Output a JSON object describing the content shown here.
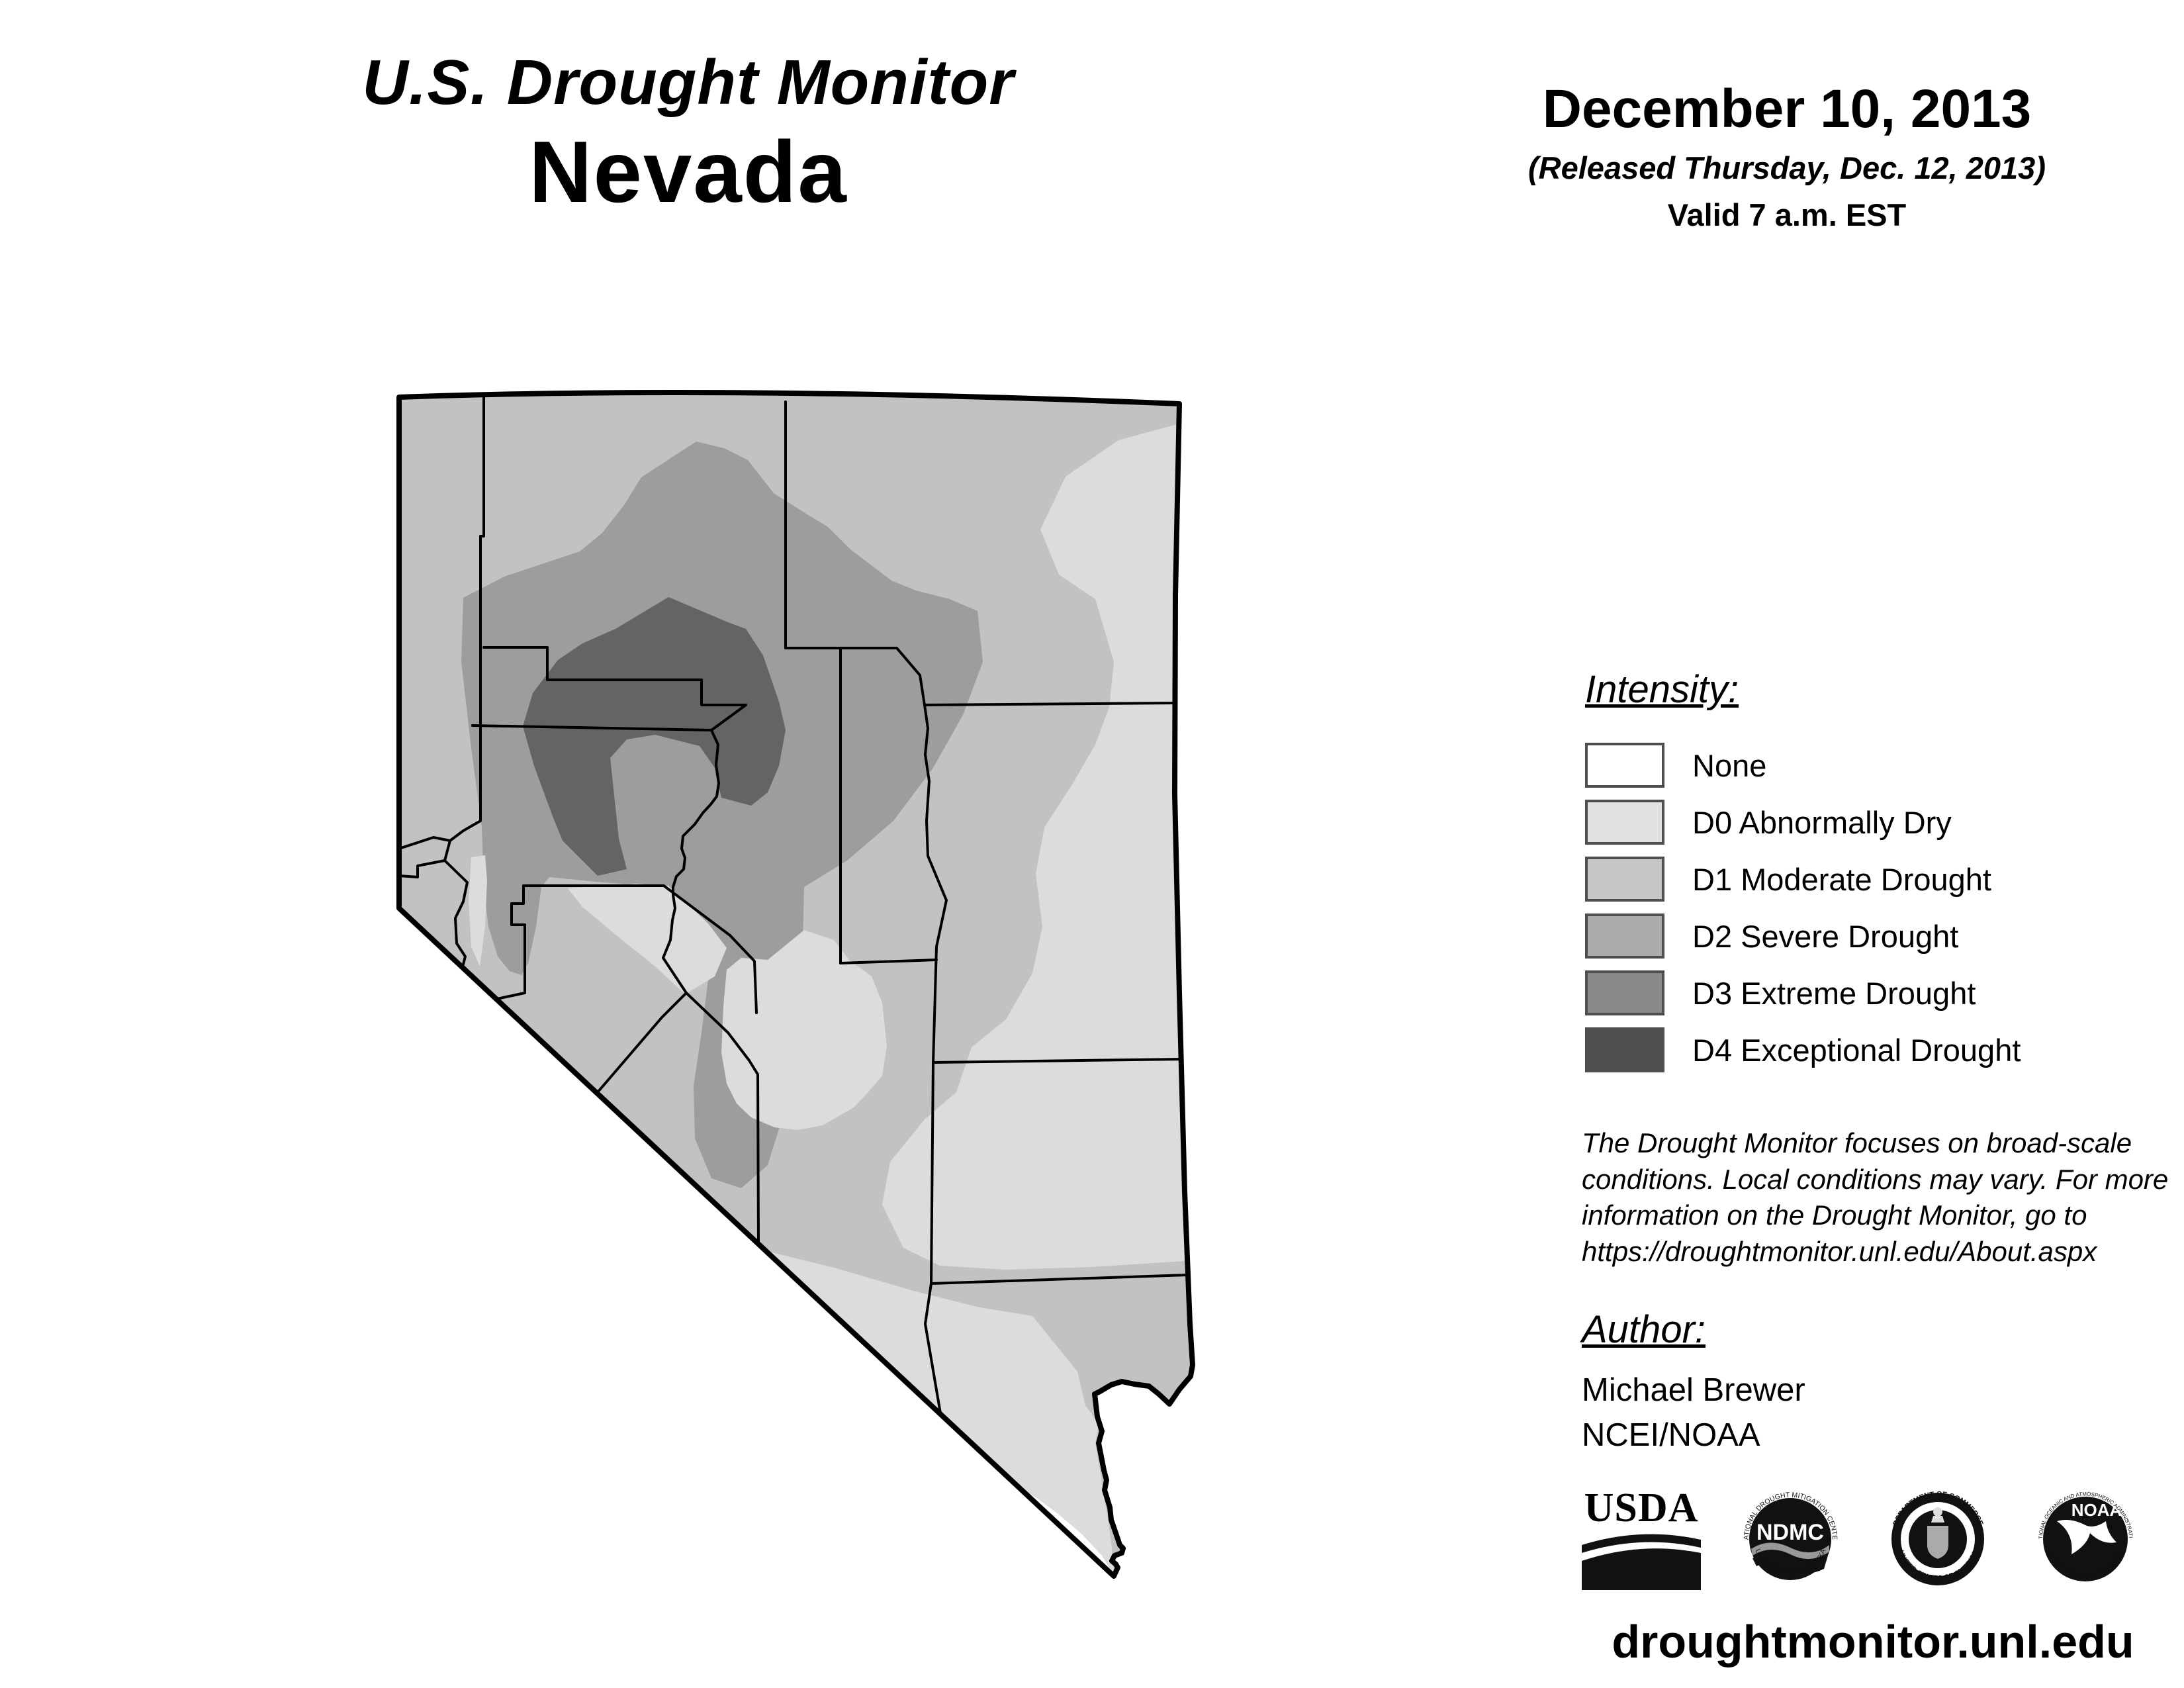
{
  "header": {
    "app_title": "U.S. Drought Monitor",
    "state": "Nevada"
  },
  "date_block": {
    "date": "December 10, 2013",
    "released": "(Released Thursday, Dec. 12, 2013)",
    "valid": "Valid 7 a.m. EST"
  },
  "legend": {
    "heading": "Intensity:",
    "items": [
      {
        "label": "None",
        "color": "#ffffff"
      },
      {
        "label": "D0 Abnormally Dry",
        "color": "#e0e0e0"
      },
      {
        "label": "D1 Moderate Drought",
        "color": "#c6c6c6"
      },
      {
        "label": "D2 Severe Drought",
        "color": "#ababab"
      },
      {
        "label": "D3 Extreme Drought",
        "color": "#8a8a8a"
      },
      {
        "label": "D4 Exceptional Drought",
        "color": "#4e4e4e"
      }
    ]
  },
  "map": {
    "state_name": "Nevada",
    "palette": {
      "none": "#ffffff",
      "d0": "#dcdcdc",
      "d1": "#c2c2c2",
      "d2": "#9d9d9d",
      "d3": "#646464",
      "line": "#000000"
    },
    "levels_shown": [
      "None",
      "D0",
      "D1",
      "D2",
      "D3"
    ]
  },
  "disclaimer": {
    "text": "The Drought Monitor focuses on broad-scale conditions. Local conditions may vary. For more information on the Drought Monitor, go to https://droughtmonitor.unl.edu/About.aspx"
  },
  "author": {
    "heading": "Author:",
    "name": "Michael Brewer",
    "org": "NCEI/NOAA"
  },
  "logos": {
    "usda": {
      "text": "USDA"
    },
    "ndmc": {
      "text": "NDMC",
      "ring_top": "NATIONAL DROUGHT MITIGATION CENTER",
      "ring_bottom": "UNIVERSITY OF NEBRASKA"
    },
    "doc": {
      "ring_top": "DEPARTMENT OF COMMERCE",
      "ring_bottom": "UNITED STATES OF AMERICA"
    },
    "noaa": {
      "text": "NOAA",
      "ring_top": "NATIONAL OCEANIC AND ATMOSPHERIC ADMINISTRATION",
      "ring_bottom": "U.S. DEPARTMENT OF COMMERCE"
    }
  },
  "footer": {
    "url": "droughtmonitor.unl.edu"
  }
}
